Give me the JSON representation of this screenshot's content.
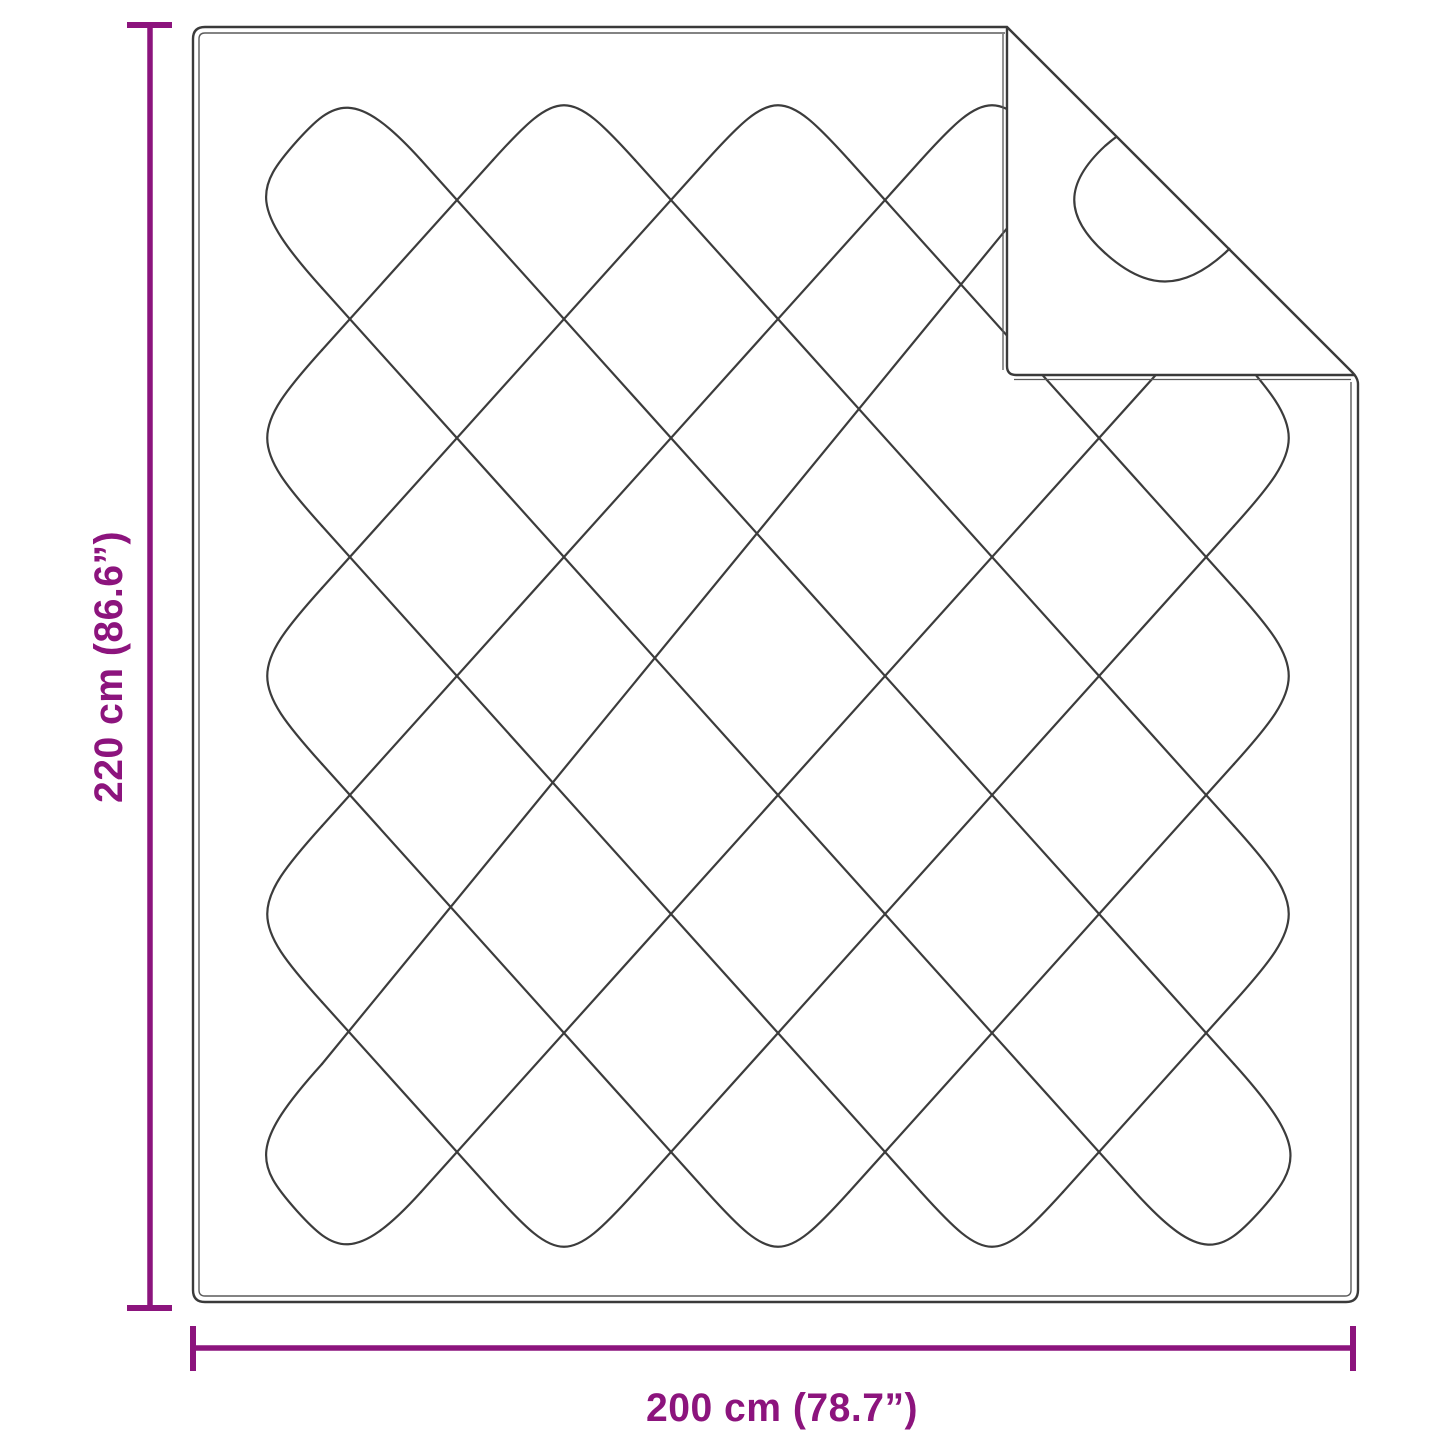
{
  "diagram_type": "product-dimension-diagram",
  "product": {
    "kind": "quilted-blanket-with-folded-corner"
  },
  "dimensions": {
    "height_label": "220 cm (86.6”)",
    "width_label": "200 cm (78.7”)"
  },
  "colors": {
    "accent": "#8C147D",
    "line": "#3C3C3C",
    "border": "#3A3A3A",
    "border_inner": "#5A5A5A",
    "background": "#FFFFFF"
  }
}
